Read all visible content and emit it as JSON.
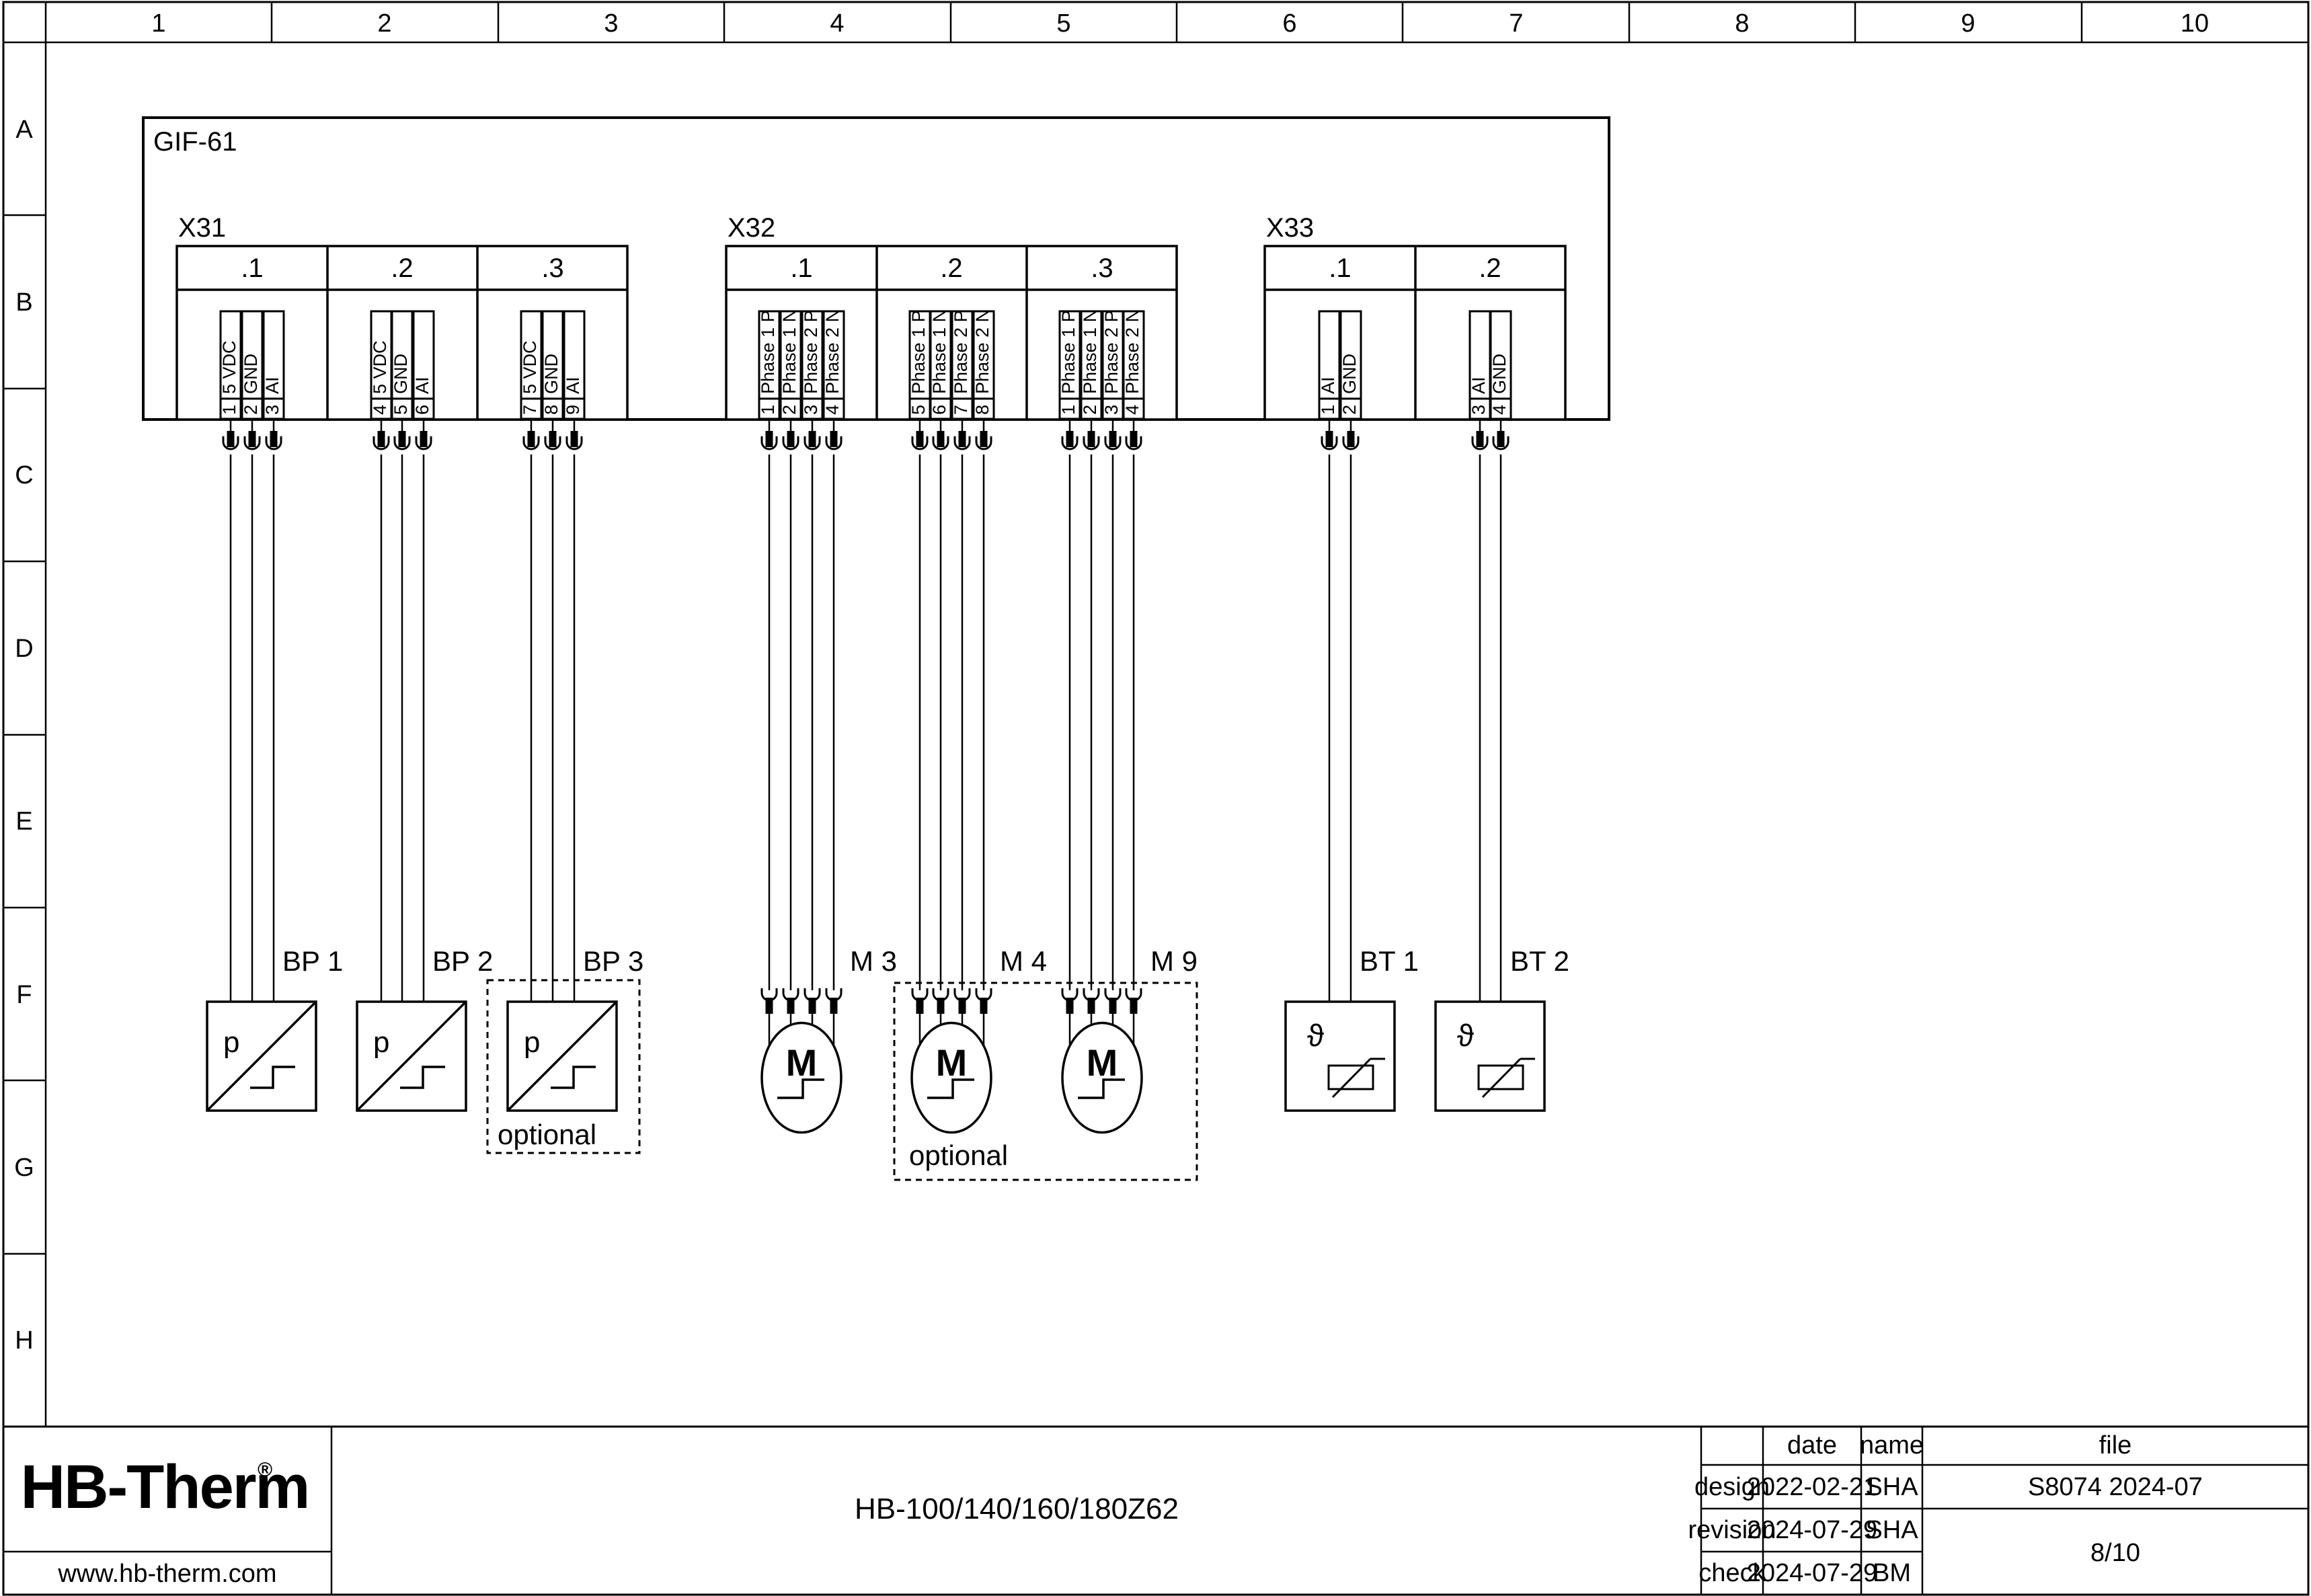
{
  "ruler": {
    "cols": [
      "1",
      "2",
      "3",
      "4",
      "5",
      "6",
      "7",
      "8",
      "9",
      "10"
    ],
    "rows": [
      "A",
      "B",
      "C",
      "D",
      "E",
      "F",
      "G",
      "H"
    ]
  },
  "device": {
    "label": "GIF-61"
  },
  "connectors": [
    {
      "label": "X31",
      "groups": [
        {
          "name": ".1",
          "pins": [
            {
              "n": "1",
              "t": "5 VDC"
            },
            {
              "n": "2",
              "t": "GND"
            },
            {
              "n": "3",
              "t": "AI"
            }
          ]
        },
        {
          "name": ".2",
          "pins": [
            {
              "n": "4",
              "t": "5 VDC"
            },
            {
              "n": "5",
              "t": "GND"
            },
            {
              "n": "6",
              "t": "AI"
            }
          ]
        },
        {
          "name": ".3",
          "pins": [
            {
              "n": "7",
              "t": "5 VDC"
            },
            {
              "n": "8",
              "t": "GND"
            },
            {
              "n": "9",
              "t": "AI"
            }
          ]
        }
      ]
    },
    {
      "label": "X32",
      "groups": [
        {
          "name": ".1",
          "pins": [
            {
              "n": "1",
              "t": "Phase 1 P"
            },
            {
              "n": "2",
              "t": "Phase 1 N"
            },
            {
              "n": "3",
              "t": "Phase 2 P"
            },
            {
              "n": "4",
              "t": "Phase 2 N"
            }
          ]
        },
        {
          "name": ".2",
          "pins": [
            {
              "n": "5",
              "t": "Phase 1 P"
            },
            {
              "n": "6",
              "t": "Phase 1 N"
            },
            {
              "n": "7",
              "t": "Phase 2 P"
            },
            {
              "n": "8",
              "t": "Phase 2 N"
            }
          ]
        },
        {
          "name": ".3",
          "pins": [
            {
              "n": "1",
              "t": "Phase 1 P"
            },
            {
              "n": "2",
              "t": "Phase 1 N"
            },
            {
              "n": "3",
              "t": "Phase 2 P"
            },
            {
              "n": "4",
              "t": "Phase 2 N"
            }
          ]
        }
      ]
    },
    {
      "label": "X33",
      "groups": [
        {
          "name": ".1",
          "pins": [
            {
              "n": "1",
              "t": "AI"
            },
            {
              "n": "2",
              "t": "GND"
            }
          ]
        },
        {
          "name": ".2",
          "pins": [
            {
              "n": "3",
              "t": "AI"
            },
            {
              "n": "4",
              "t": "GND"
            }
          ]
        }
      ]
    }
  ],
  "symbols": {
    "pressure": "p",
    "motor": "M",
    "temperature": "ϑ"
  },
  "components": {
    "bp1": {
      "label": "BP 1"
    },
    "bp2": {
      "label": "BP 2"
    },
    "bp3": {
      "label": "BP 3"
    },
    "m3": {
      "label": "M 3"
    },
    "m4": {
      "label": "M 4"
    },
    "m9": {
      "label": "M 9"
    },
    "bt1": {
      "label": "BT 1"
    },
    "bt2": {
      "label": "BT 2"
    },
    "optional_label": "optional"
  },
  "title_block": {
    "logo": "HB-Therm",
    "logo_reg": "®",
    "logo_color": "#1e2a45",
    "website": "www.hb-therm.com",
    "drawing_title": "HB-100/140/160/180Z62",
    "table": {
      "headers": {
        "date": "date",
        "name": "name",
        "file": "file"
      },
      "rows": [
        {
          "label": "design",
          "date": "2022-02-21",
          "name": "SHA",
          "file": "S8074 2024-07"
        },
        {
          "label": "revision",
          "date": "2024-07-29",
          "name": "SHA"
        },
        {
          "label": "check",
          "date": "2024-07-29",
          "name": "BM"
        }
      ],
      "page": "8/10"
    }
  }
}
